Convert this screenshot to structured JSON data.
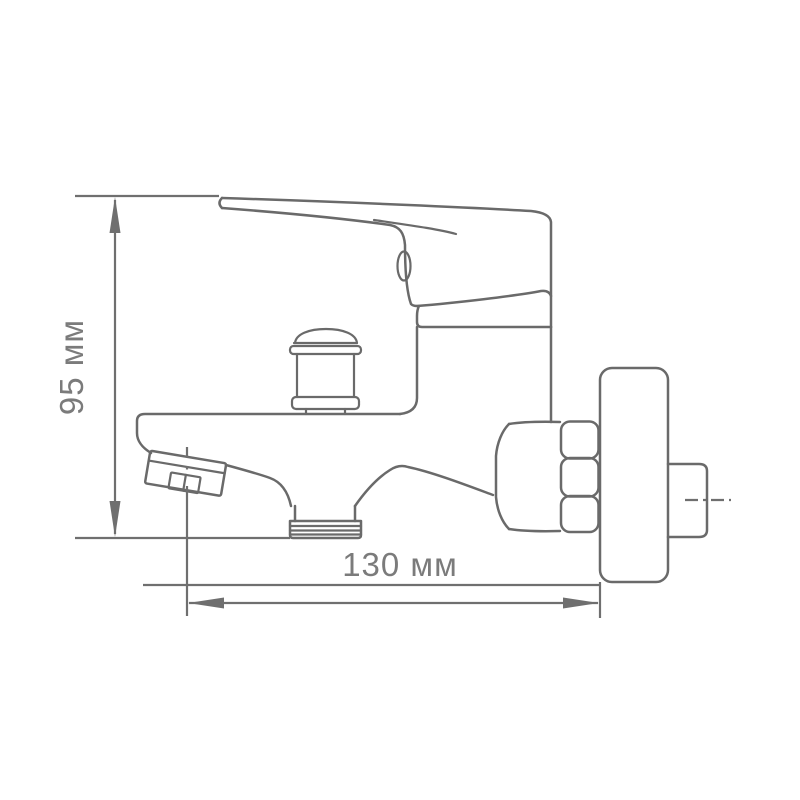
{
  "drawing": {
    "kind": "technical-dimension-drawing",
    "subject": "wall-mounted-bath-mixer-faucet-side-view",
    "background_color": "#ffffff",
    "line_color": "#6a6a6a",
    "label_color": "#7b7b7b",
    "dimensions": {
      "height": {
        "label": "95 мм",
        "value": 95,
        "unit": "мм",
        "orientation": "vertical"
      },
      "reach": {
        "label": "130 мм",
        "value": 130,
        "unit": "мм",
        "orientation": "horizontal"
      }
    },
    "parts": [
      "lever-handle",
      "cartridge-cap",
      "mixer-body",
      "diverter-knob",
      "spout",
      "aerator",
      "shower-hose-outlet",
      "connection-nut",
      "hex-nut",
      "wall-escutcheon",
      "wall-pipe"
    ]
  }
}
